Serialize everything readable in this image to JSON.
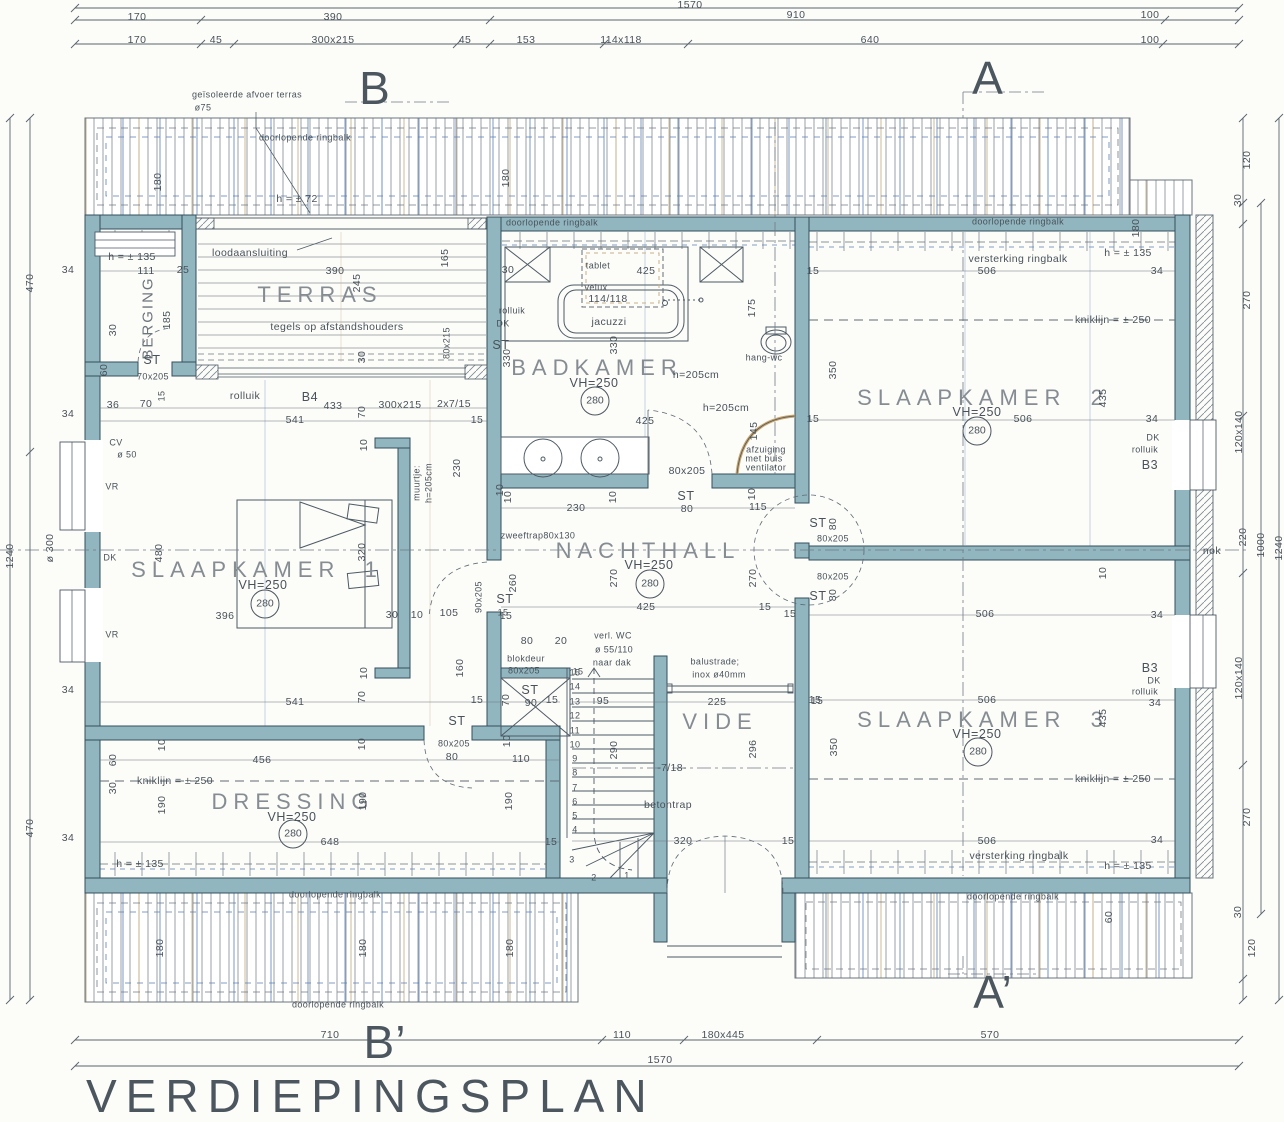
{
  "meta": {
    "title": "VERDIEPINGSPLAN",
    "drawing_type": "architectural floor plan (upper storey)"
  },
  "rooms": [
    {
      "name": "BERGING",
      "height": "ST 70x205"
    },
    {
      "name": "TERRAS",
      "note": "tegels op afstandshouders",
      "size": "390 x 245"
    },
    {
      "name": "BADKAMER",
      "vh": "VH=250",
      "level": "280"
    },
    {
      "name": "SLAAPKAMER  1",
      "vh": "VH=250",
      "level": "280"
    },
    {
      "name": "SLAAPKAMER  2",
      "vh": "VH=250",
      "level": "280"
    },
    {
      "name": "SLAAPKAMER  3",
      "vh": "VH=250",
      "level": "280"
    },
    {
      "name": "NACHTHALL",
      "vh": "VH=250",
      "level": "280"
    },
    {
      "name": "DRESSING",
      "vh": "VH=250",
      "level": "280"
    },
    {
      "name": "VIDE",
      "size": "225 x 296"
    }
  ],
  "section_markers": [
    "B",
    "A",
    "B’",
    "A’"
  ],
  "labels": [
    [
      690,
      5,
      "1570"
    ],
    [
      137,
      17,
      "170"
    ],
    [
      333,
      17,
      "390"
    ],
    [
      796,
      15,
      "910"
    ],
    [
      1150,
      15,
      "100"
    ],
    [
      137,
      40,
      "170"
    ],
    [
      216,
      40,
      "45"
    ],
    [
      333,
      40,
      "300x215"
    ],
    [
      465,
      40,
      "45"
    ],
    [
      526,
      40,
      "153"
    ],
    [
      621,
      40,
      "114x118"
    ],
    [
      870,
      40,
      "640"
    ],
    [
      1150,
      40,
      "100"
    ],
    [
      30,
      283,
      "470",
      "r"
    ],
    [
      50,
      548,
      "ø 300",
      "r"
    ],
    [
      30,
      828,
      "470",
      "r"
    ],
    [
      10,
      556,
      "1240",
      "r"
    ],
    [
      68,
      270,
      "34"
    ],
    [
      68,
      414,
      "34"
    ],
    [
      68,
      690,
      "34"
    ],
    [
      68,
      838,
      "34"
    ],
    [
      1247,
      160,
      "120",
      "r"
    ],
    [
      1238,
      200,
      "30",
      "r"
    ],
    [
      1247,
      300,
      "270",
      "r"
    ],
    [
      1239,
      432,
      "120x140",
      "r"
    ],
    [
      1243,
      537,
      "220",
      "r"
    ],
    [
      1261,
      545,
      "1000",
      "r"
    ],
    [
      1279,
      548,
      "1240",
      "r"
    ],
    [
      1239,
      678,
      "120x140",
      "r"
    ],
    [
      1247,
      817,
      "270",
      "r"
    ],
    [
      1238,
      912,
      "30",
      "r"
    ],
    [
      1252,
      948,
      "120",
      "r"
    ],
    [
      1212,
      551,
      "nok"
    ],
    [
      330,
      1035,
      "710"
    ],
    [
      622,
      1035,
      "110"
    ],
    [
      723,
      1035,
      "180x445"
    ],
    [
      990,
      1035,
      "570"
    ],
    [
      660,
      1060,
      "1570"
    ],
    [
      375,
      88,
      "B",
      "big"
    ],
    [
      988,
      78,
      "A",
      "big"
    ],
    [
      385,
      1042,
      "B’",
      "big"
    ],
    [
      993,
      992,
      "A’",
      "big"
    ],
    [
      305,
      138,
      "doorlopende ringbalk",
      "s"
    ],
    [
      552,
      223,
      "doorlopende ringbalk",
      "s"
    ],
    [
      1018,
      222,
      "doorlopende ringbalk",
      "s"
    ],
    [
      335,
      895,
      "doorlopende ringbalk",
      "s"
    ],
    [
      1013,
      897,
      "doorlopende ringbalk",
      "s"
    ],
    [
      338,
      1005,
      "doorlopende ringbalk",
      "s"
    ],
    [
      158,
      182,
      "180",
      "r"
    ],
    [
      506,
      178,
      "180",
      "r"
    ],
    [
      1136,
      228,
      "180",
      "r"
    ],
    [
      160,
      948,
      "180",
      "r"
    ],
    [
      363,
      948,
      "180",
      "r"
    ],
    [
      510,
      948,
      "180",
      "r"
    ],
    [
      1109,
      917,
      "60",
      "r"
    ],
    [
      247,
      95,
      "geïsoleerde afvoer terras",
      "s"
    ],
    [
      203,
      108,
      "ø75",
      "s"
    ],
    [
      297,
      199,
      "h = ± 72"
    ],
    [
      132,
      257,
      "h = ± 135"
    ],
    [
      146,
      271,
      "111"
    ],
    [
      183,
      270,
      "25"
    ],
    [
      148,
      318,
      "BERGING",
      "bv"
    ],
    [
      167,
      320,
      "185",
      "r"
    ],
    [
      113,
      330,
      "30",
      "r"
    ],
    [
      104,
      370,
      "60",
      "r"
    ],
    [
      152,
      360,
      "ST",
      "m"
    ],
    [
      153,
      377,
      "70x205",
      "s"
    ],
    [
      162,
      396,
      "15",
      "sr"
    ],
    [
      113,
      405,
      "36"
    ],
    [
      146,
      404,
      "70"
    ],
    [
      250,
      253,
      "loodaansluiting"
    ],
    [
      335,
      271,
      "390"
    ],
    [
      357,
      283,
      "245",
      "r"
    ],
    [
      320,
      295,
      "TERRAS",
      "room"
    ],
    [
      445,
      258,
      "165",
      "r"
    ],
    [
      337,
      327,
      "tegels op afstandshouders"
    ],
    [
      447,
      343,
      "80x215",
      "sr"
    ],
    [
      362,
      357,
      "30",
      "r"
    ],
    [
      245,
      396,
      "rolluik"
    ],
    [
      310,
      397,
      "B4",
      "m"
    ],
    [
      333,
      406,
      "433"
    ],
    [
      400,
      405,
      "300x215"
    ],
    [
      454,
      404,
      "2x7/15"
    ],
    [
      295,
      420,
      "541"
    ],
    [
      362,
      412,
      "70",
      "r"
    ],
    [
      477,
      420,
      "15"
    ],
    [
      364,
      445,
      "10",
      "r"
    ],
    [
      508,
      270,
      "30"
    ],
    [
      598,
      266,
      "tablet",
      "s"
    ],
    [
      646,
      271,
      "425"
    ],
    [
      596,
      288,
      "velux",
      "s"
    ],
    [
      608,
      299,
      "114/118"
    ],
    [
      609,
      322,
      "jacuzzi"
    ],
    [
      752,
      308,
      "175",
      "r"
    ],
    [
      512,
      311,
      "rolluik",
      "s"
    ],
    [
      503,
      324,
      "DK",
      "s"
    ],
    [
      501,
      345,
      "ST",
      "m"
    ],
    [
      507,
      358,
      "330",
      "r"
    ],
    [
      614,
      345,
      "330",
      "r"
    ],
    [
      597,
      368,
      "BADKAMER",
      "room"
    ],
    [
      594,
      383,
      "VH=250",
      "m"
    ],
    [
      595,
      401,
      "280",
      "circ"
    ],
    [
      764,
      358,
      "hang-wc",
      "s"
    ],
    [
      696,
      375,
      "h=205cm"
    ],
    [
      726,
      408,
      "h=205cm"
    ],
    [
      645,
      421,
      "425"
    ],
    [
      754,
      431,
      "145",
      "r"
    ],
    [
      766,
      450,
      "afzuiging",
      "s"
    ],
    [
      764,
      459,
      "met buis",
      "s"
    ],
    [
      766,
      468,
      "ventilator",
      "s"
    ],
    [
      687,
      471,
      "80x205"
    ],
    [
      500,
      490,
      "10",
      "r"
    ],
    [
      508,
      497,
      "10",
      "r"
    ],
    [
      576,
      508,
      "230"
    ],
    [
      613,
      497,
      "10",
      "r"
    ],
    [
      686,
      496,
      "ST",
      "m"
    ],
    [
      687,
      509,
      "80"
    ],
    [
      758,
      507,
      "115"
    ],
    [
      752,
      494,
      "10",
      "r"
    ],
    [
      538,
      536,
      "zweeftrap80x130",
      "s"
    ],
    [
      648,
      551,
      "NACHTHALL",
      "room"
    ],
    [
      649,
      565,
      "VH=250",
      "m"
    ],
    [
      614,
      578,
      "270",
      "r"
    ],
    [
      650,
      584,
      "280",
      "circ"
    ],
    [
      753,
      578,
      "270",
      "r"
    ],
    [
      505,
      599,
      "ST",
      "m"
    ],
    [
      513,
      583,
      "260",
      "r"
    ],
    [
      506,
      616,
      "15"
    ],
    [
      646,
      607,
      "425"
    ],
    [
      765,
      607,
      "15"
    ],
    [
      527,
      641,
      "80"
    ],
    [
      561,
      641,
      "20"
    ],
    [
      613,
      636,
      "verl. WC",
      "s"
    ],
    [
      614,
      650,
      "ø 55/110",
      "s"
    ],
    [
      612,
      663,
      "naar dak",
      "s"
    ],
    [
      526,
      659,
      "blokdeur",
      "s"
    ],
    [
      524,
      671,
      "80x205",
      "s"
    ],
    [
      578,
      672,
      "15",
      "s"
    ],
    [
      449,
      613,
      "105"
    ],
    [
      392,
      615,
      "30"
    ],
    [
      417,
      615,
      "10"
    ],
    [
      479,
      597,
      "90x205",
      "sr"
    ],
    [
      503,
      613,
      "15",
      "s"
    ],
    [
      460,
      668,
      "160",
      "r"
    ],
    [
      506,
      700,
      "70",
      "r"
    ],
    [
      530,
      690,
      "ST",
      "m"
    ],
    [
      531,
      703,
      "90"
    ],
    [
      552,
      700,
      "15"
    ],
    [
      457,
      721,
      "ST",
      "m"
    ],
    [
      454,
      744,
      "80x205",
      "s"
    ],
    [
      452,
      757,
      "80"
    ],
    [
      521,
      759,
      "110"
    ],
    [
      507,
      741,
      "10",
      "r"
    ],
    [
      159,
      553,
      "480",
      "r"
    ],
    [
      257,
      570,
      "SLAAPKAMER  1",
      "room"
    ],
    [
      263,
      585,
      "VH=250",
      "m"
    ],
    [
      265,
      604,
      "280",
      "circ"
    ],
    [
      225,
      616,
      "396"
    ],
    [
      116,
      443,
      "CV",
      "s"
    ],
    [
      127,
      455,
      "ø 50",
      "s"
    ],
    [
      112,
      487,
      "VR",
      "s"
    ],
    [
      110,
      558,
      "DK",
      "s"
    ],
    [
      112,
      635,
      "VR",
      "s"
    ],
    [
      417,
      483,
      "muurtje:",
      "sr"
    ],
    [
      429,
      483,
      "h=205cm",
      "sr"
    ],
    [
      457,
      468,
      "230",
      "r"
    ],
    [
      362,
      552,
      "320",
      "r"
    ],
    [
      364,
      673,
      "10",
      "r"
    ],
    [
      295,
      702,
      "541"
    ],
    [
      362,
      697,
      "70",
      "r"
    ],
    [
      477,
      700,
      "15"
    ],
    [
      113,
      760,
      "60",
      "r"
    ],
    [
      162,
      745,
      "10",
      "r"
    ],
    [
      262,
      760,
      "456"
    ],
    [
      362,
      744,
      "10",
      "r"
    ],
    [
      175,
      781,
      "kniklijn = ± 250"
    ],
    [
      113,
      788,
      "30",
      "r"
    ],
    [
      162,
      805,
      "190",
      "r"
    ],
    [
      293,
      802,
      "DRESSING",
      "room"
    ],
    [
      292,
      817,
      "VH=250",
      "m"
    ],
    [
      363,
      801,
      "190",
      "r"
    ],
    [
      509,
      801,
      "190",
      "r"
    ],
    [
      293,
      834,
      "280",
      "circ"
    ],
    [
      330,
      842,
      "648"
    ],
    [
      551,
      842,
      "15"
    ],
    [
      140,
      864,
      "h = ± 135"
    ],
    [
      575,
      673,
      "15",
      "s"
    ],
    [
      575,
      687,
      "14",
      "s"
    ],
    [
      575,
      702,
      "13",
      "s"
    ],
    [
      575,
      716,
      "12",
      "s"
    ],
    [
      575,
      731,
      "11",
      "s"
    ],
    [
      575,
      745,
      "10",
      "s"
    ],
    [
      575,
      759,
      "9",
      "s"
    ],
    [
      575,
      773,
      "8",
      "s"
    ],
    [
      575,
      788,
      "7",
      "s"
    ],
    [
      575,
      802,
      "6",
      "s"
    ],
    [
      575,
      816,
      "5",
      "s"
    ],
    [
      575,
      830,
      "4",
      "s"
    ],
    [
      572,
      860,
      "3",
      "s"
    ],
    [
      594,
      878,
      "2",
      "s"
    ],
    [
      627,
      876,
      "1",
      "s"
    ],
    [
      603,
      701,
      "95"
    ],
    [
      614,
      750,
      "290",
      "r"
    ],
    [
      717,
      702,
      "225"
    ],
    [
      720,
      722,
      "VIDE",
      "room"
    ],
    [
      753,
      749,
      "296",
      "r"
    ],
    [
      834,
      747,
      "350",
      "r"
    ],
    [
      817,
      701,
      "15"
    ],
    [
      672,
      768,
      "-7/18-"
    ],
    [
      668,
      805,
      "betontrap"
    ],
    [
      683,
      841,
      "320"
    ],
    [
      788,
      841,
      "15"
    ],
    [
      715,
      662,
      "balustrade;",
      "s"
    ],
    [
      719,
      675,
      "inox ø40mm",
      "s"
    ],
    [
      1018,
      259,
      "versterking ringbalk"
    ],
    [
      1128,
      253,
      "h = ± 135"
    ],
    [
      987,
      271,
      "506"
    ],
    [
      813,
      271,
      "15"
    ],
    [
      1157,
      271,
      "34"
    ],
    [
      1113,
      320,
      "kniklijn = ± 250"
    ],
    [
      833,
      370,
      "350",
      "r"
    ],
    [
      983,
      398,
      "SLAAPKAMER  2",
      "room"
    ],
    [
      977,
      412,
      "VH=250",
      "m"
    ],
    [
      1103,
      398,
      "435",
      "r"
    ],
    [
      1023,
      419,
      "506"
    ],
    [
      977,
      431,
      "280",
      "circ"
    ],
    [
      813,
      419,
      "15"
    ],
    [
      1152,
      419,
      "34"
    ],
    [
      1153,
      438,
      "DK",
      "s"
    ],
    [
      1145,
      450,
      "rolluik",
      "s"
    ],
    [
      1150,
      465,
      "B3",
      "m"
    ],
    [
      818,
      523,
      "ST",
      "m"
    ],
    [
      833,
      524,
      "80",
      "r"
    ],
    [
      833,
      539,
      "80x205",
      "s"
    ],
    [
      833,
      577,
      "80x205",
      "s"
    ],
    [
      818,
      596,
      "ST",
      "m"
    ],
    [
      833,
      595,
      "80",
      "r"
    ],
    [
      790,
      614,
      "15"
    ],
    [
      985,
      614,
      "506"
    ],
    [
      1103,
      573,
      "10",
      "r"
    ],
    [
      1157,
      615,
      "34"
    ],
    [
      815,
      700,
      "15"
    ],
    [
      987,
      700,
      "506"
    ],
    [
      1150,
      668,
      "B3",
      "m"
    ],
    [
      1154,
      681,
      "DK",
      "s"
    ],
    [
      1145,
      692,
      "rolluik",
      "s"
    ],
    [
      1155,
      703,
      "34"
    ],
    [
      983,
      720,
      "SLAAPKAMER  3",
      "room"
    ],
    [
      977,
      734,
      "VH=250",
      "m"
    ],
    [
      1103,
      718,
      "435",
      "r"
    ],
    [
      978,
      752,
      "280",
      "circ"
    ],
    [
      1113,
      779,
      "kniklijn = ± 250"
    ],
    [
      987,
      841,
      "506"
    ],
    [
      1157,
      840,
      "34"
    ],
    [
      1019,
      856,
      "versterking ringbalk"
    ],
    [
      1128,
      866,
      "h = ± 135"
    ]
  ],
  "colors": {
    "wall_fill": "#92b6bf",
    "wall_edge": "#33505e",
    "line": "#4d5a64",
    "hatch_blue": "#6d8fc0",
    "hatch_tan": "#c9b088",
    "text": "#49525a"
  }
}
